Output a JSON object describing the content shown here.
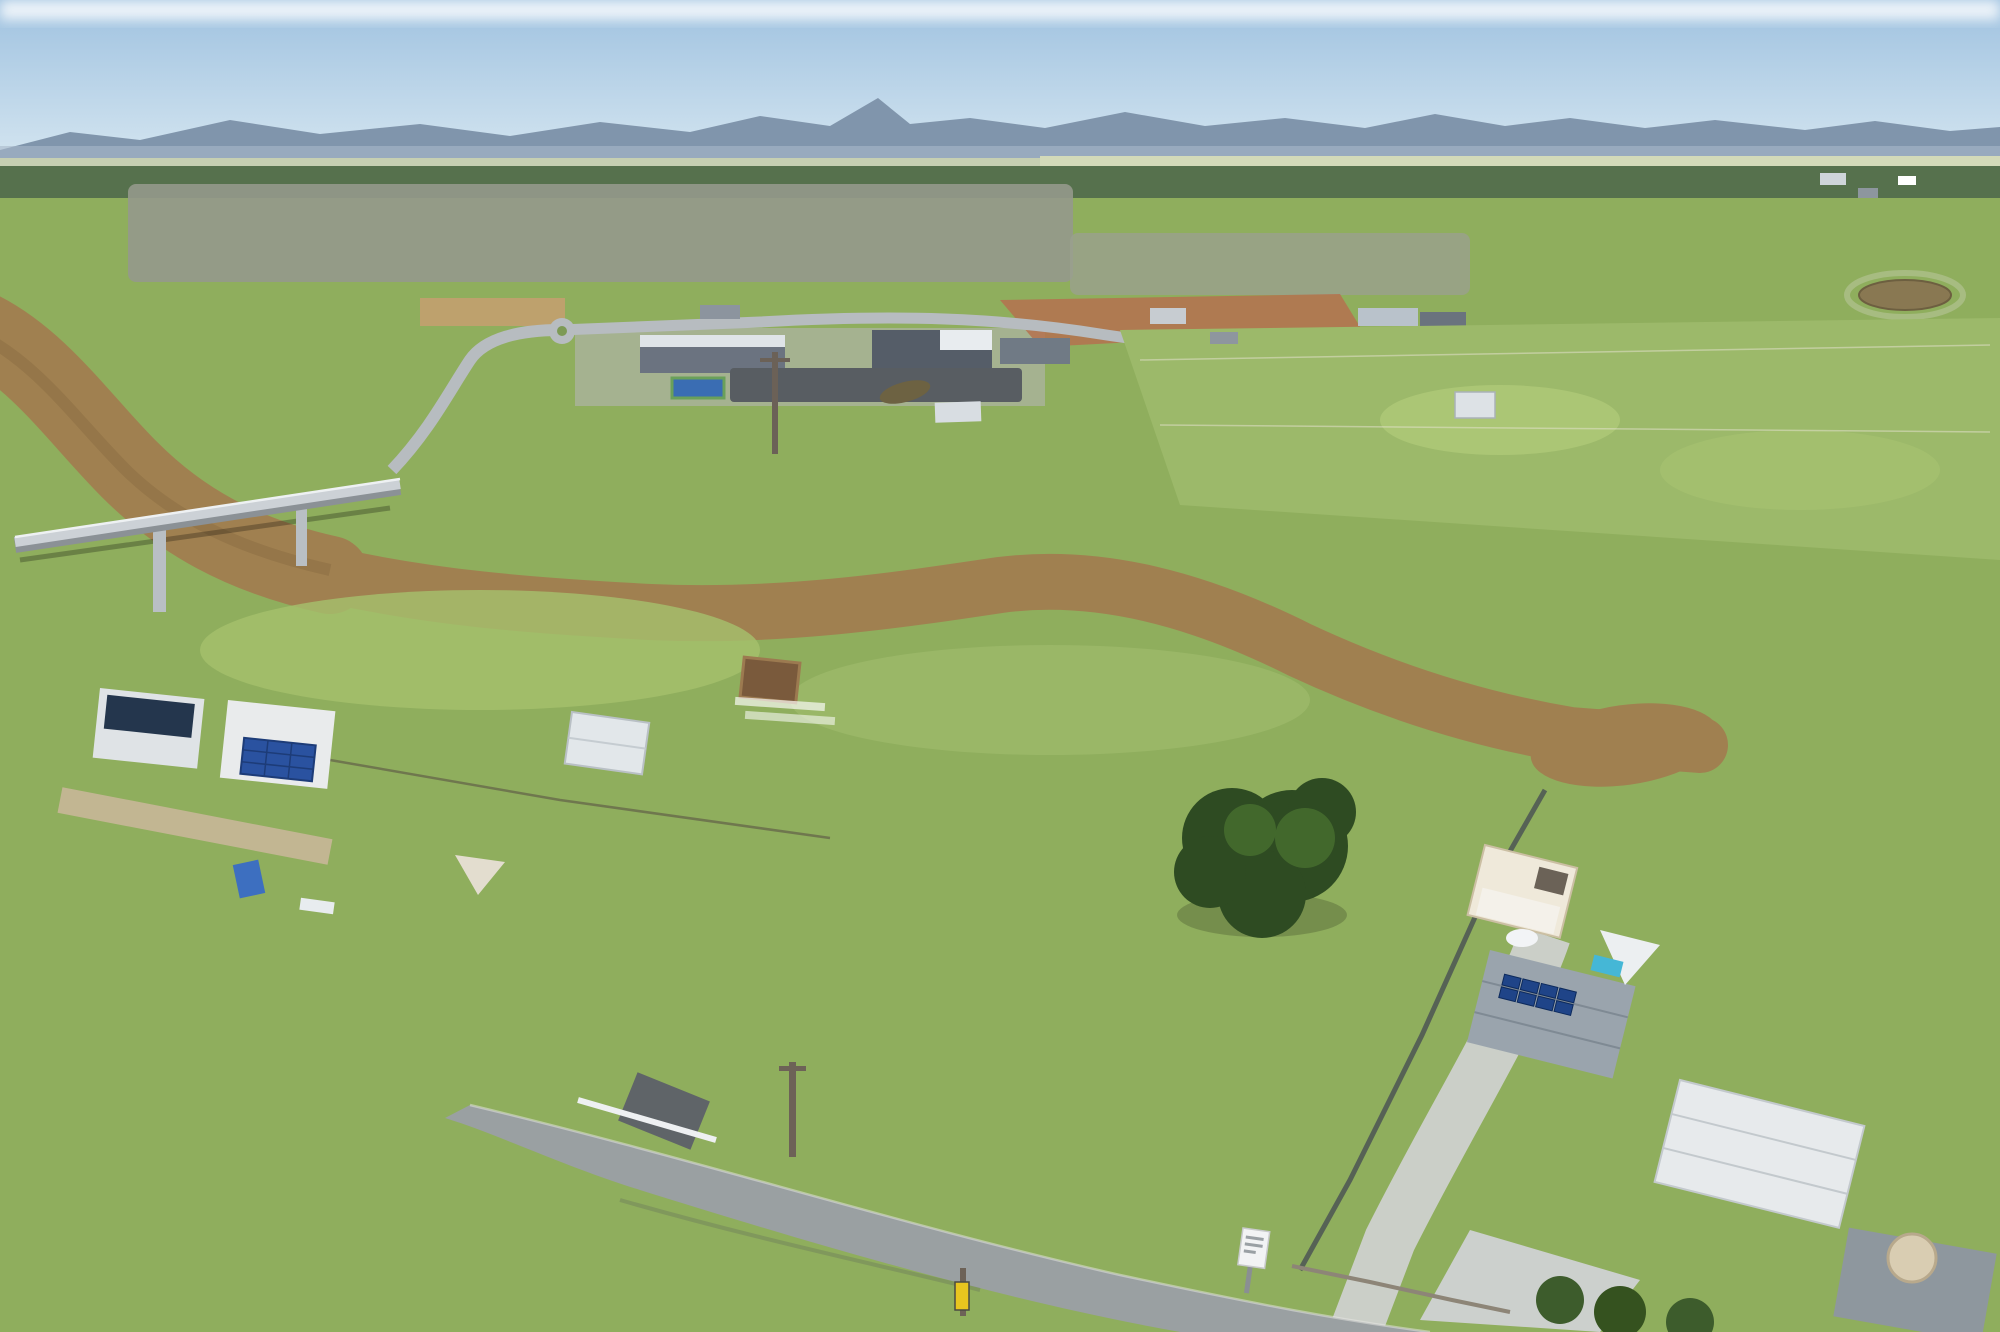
{
  "scene": {
    "description": "Aerial drone photo of two vacant riverside acreage lots outlined in red, Logan River and King's Christian College in view",
    "labels": {
      "college": "King's Christian College",
      "river_left": "Logan River",
      "river_right": "Logan River"
    },
    "colors": {
      "boundary_red": "#f30d1c",
      "marker_red": "#ee1220",
      "marker_rim": "#8f0d16",
      "callout_white": "#ffffff",
      "callout_outline": "#1c1c1c",
      "label_fill": "#ffffff",
      "label_outline": "#262626",
      "river_water": "#a08050",
      "sky_blue": "#9fc2e0"
    },
    "marker": {
      "cx": "920",
      "cy": "322",
      "r": "17"
    },
    "callout_path": "M398,96 L919,96 L919,322",
    "boundary": {
      "lots": "2",
      "outer_points": "1245,783 1392,782 1538,775 1527,805 1483,890 1420,1032 1350,1165 1285,1263 1120,1230 1035,1208 980,1197 827,1165 943,1050 1033,950 1130,863 1192,820",
      "divider_points": "1392,782 1312,878 1262,940 1198,1012 1120,1100 1062,1168 1035,1208"
    }
  }
}
